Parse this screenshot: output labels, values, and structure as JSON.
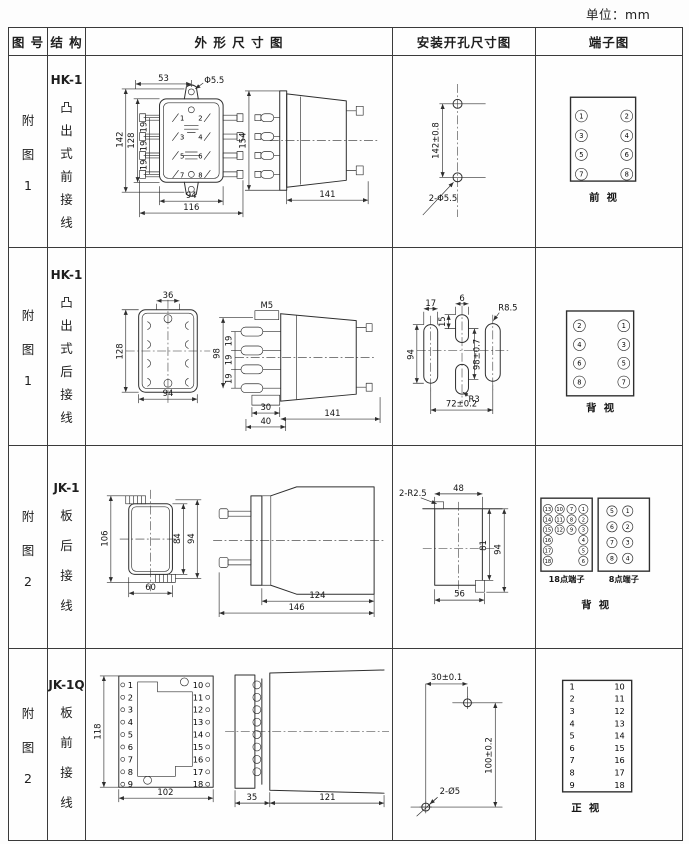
{
  "unit_note": "单位：mm",
  "header": {
    "fig": "图 号",
    "structure": "结 构",
    "outline": "外 形 尺 寸 图",
    "mounting": "安装开孔尺寸图",
    "terminal": "端子图"
  },
  "rows": [
    {
      "fig": [
        "附",
        "图",
        "1"
      ],
      "model": "HK-1",
      "structure": [
        "凸",
        "出",
        "式",
        "前",
        "接",
        "线"
      ],
      "outline": {
        "dim_53": "53",
        "dim_hole": "Φ5.5",
        "dim_142": "142",
        "dim_128": "128",
        "pitch": [
          "19",
          "19",
          "19"
        ],
        "pins_left": [
          "1",
          "3",
          "5",
          "7"
        ],
        "pins_right": [
          "2",
          "4",
          "6",
          "8"
        ],
        "dim_94": "94",
        "dim_116": "116",
        "dim_154": "154",
        "dim_141": "141"
      },
      "mounting": {
        "dim_v": "142±0.8",
        "holes": "2-Φ5.5"
      },
      "terminal": {
        "left": [
          "1",
          "3",
          "5",
          "7"
        ],
        "right": [
          "2",
          "4",
          "6",
          "8"
        ],
        "view": "前  视"
      }
    },
    {
      "fig": [
        "附",
        "图",
        "1"
      ],
      "model": "HK-1",
      "structure": [
        "凸",
        "出",
        "式",
        "后",
        "接",
        "线"
      ],
      "outline": {
        "dim_36": "36",
        "dim_128": "128",
        "dim_94": "94",
        "stud": "M5",
        "pitch": [
          "19",
          "19",
          "19"
        ],
        "dim_98": "98",
        "dim_30": "30",
        "dim_40": "40",
        "dim_141": "141"
      },
      "mounting": {
        "dim_17": "17",
        "dim_6": "6",
        "dim_15": "15",
        "dim_94": "94",
        "dim_98": "98±0.7",
        "r1": "R8.5",
        "r2": "R3",
        "dim_72": "72±0.2"
      },
      "terminal": {
        "left": [
          "2",
          "4",
          "6",
          "8"
        ],
        "right": [
          "1",
          "3",
          "5",
          "7"
        ],
        "view": "背  视"
      }
    },
    {
      "fig": [
        "附",
        "图",
        "2"
      ],
      "model": "JK-1",
      "structure": [
        "板",
        "后",
        "接",
        "线"
      ],
      "outline": {
        "dim_106": "106",
        "dim_84": "84",
        "dim_94": "94",
        "dim_60": "60",
        "dim_124": "124",
        "dim_146": "146"
      },
      "mounting": {
        "corner": "2-R2.5",
        "dim_48": "48",
        "dim_81": "81",
        "dim_94": "94",
        "dim_56": "56"
      },
      "terminal": {
        "p18": [
          [
            "13",
            "14",
            "15",
            "16",
            "17",
            "18"
          ],
          [
            "10",
            "11",
            "12"
          ],
          [
            "7",
            "8",
            "9"
          ],
          [
            "1",
            "2",
            "3",
            "4",
            "5",
            "6"
          ]
        ],
        "p18_label": "18点端子",
        "p8_left": [
          "5",
          "6",
          "7",
          "8"
        ],
        "p8_right": [
          "1",
          "2",
          "3",
          "4"
        ],
        "p8_label": "8点端子",
        "view": "背  视"
      }
    },
    {
      "fig": [
        "附",
        "图",
        "2"
      ],
      "model": "JK-1Q",
      "structure": [
        "板",
        "前",
        "接",
        "线"
      ],
      "outline": {
        "dim_118": "118",
        "pins_left": [
          "1",
          "2",
          "3",
          "4",
          "5",
          "6",
          "7",
          "8",
          "9"
        ],
        "pins_right": [
          "10",
          "11",
          "12",
          "13",
          "14",
          "15",
          "16",
          "17",
          "18"
        ],
        "dim_102": "102",
        "dim_35": "35",
        "dim_121": "121"
      },
      "mounting": {
        "dim_30": "30±0.1",
        "dim_100": "100±0.2",
        "holes": "2-Ø5"
      },
      "terminal": {
        "left": [
          "1",
          "2",
          "3",
          "4",
          "5",
          "6",
          "7",
          "8",
          "9"
        ],
        "right": [
          "10",
          "11",
          "12",
          "13",
          "14",
          "15",
          "16",
          "17",
          "18"
        ],
        "view": "正  视"
      }
    }
  ]
}
